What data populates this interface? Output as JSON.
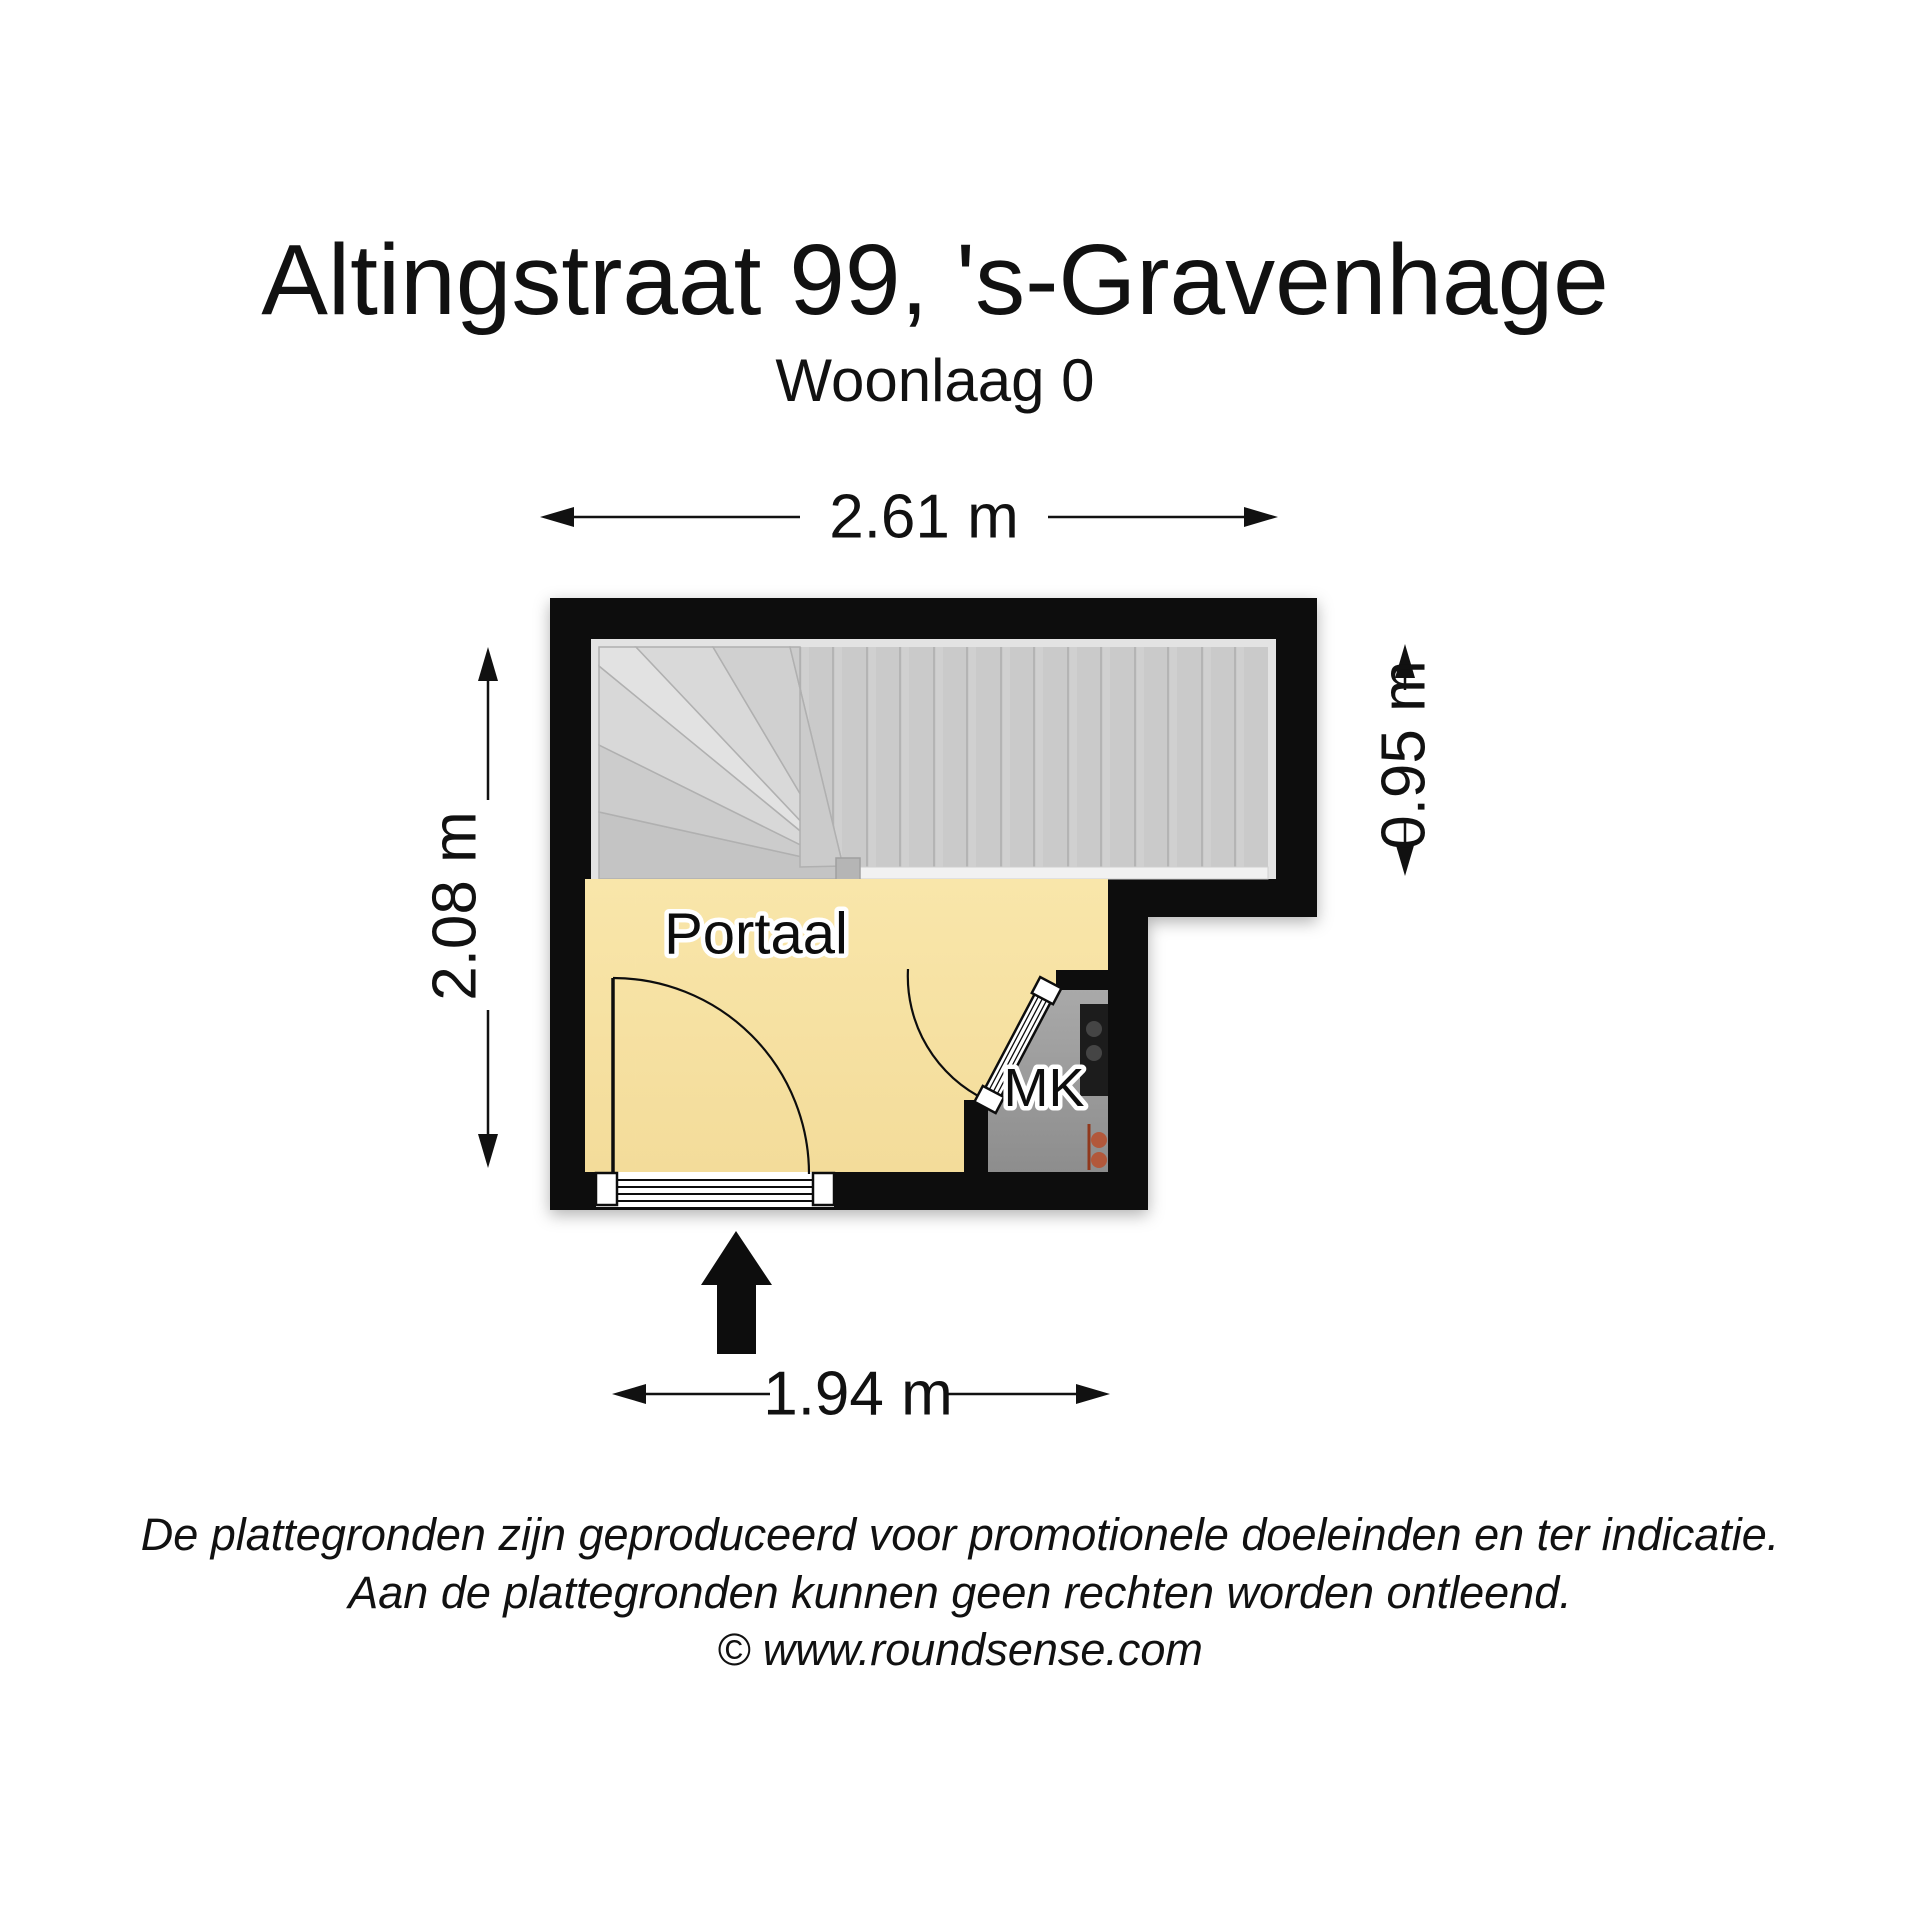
{
  "header": {
    "title": "Altingstraat 99, 's-Gravenhage",
    "subtitle": "Woonlaag 0"
  },
  "floorplan": {
    "rooms": {
      "portaal": "Portaal",
      "mk": "MK"
    },
    "dimensions": {
      "top": "2.61 m",
      "left": "2.08 m",
      "right": "0.95 m",
      "bottom": "1.94 m"
    }
  },
  "footer": {
    "disclaimer_line1": "De plattegronden zijn geproduceerd voor promotionele doeleinden en ter indicatie.",
    "disclaimer_line2": "Aan de plattegronden kunnen geen rechten worden ontleend.",
    "copyright": "© www.roundsense.com"
  },
  "colors": {
    "wall": "#0a0a0a",
    "room_fill": "#f7e2a2",
    "stair_fill": "#cacaca",
    "stair_border": "#e3e3e3",
    "mk_fill": "#9d9d9d",
    "meter_panel": "#1e1e1e",
    "accent_orange": "#b2583a"
  }
}
